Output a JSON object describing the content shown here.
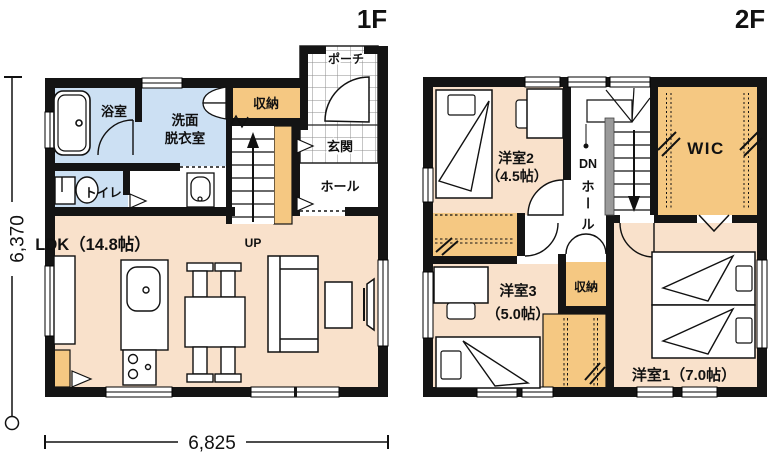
{
  "floor1": {
    "title": "1F",
    "rooms": {
      "bath": "浴室",
      "washroom1": "洗面",
      "washroom2": "脱衣室",
      "toilet": "トイレ",
      "storage": "収納",
      "porch": "ポーチ",
      "entrance": "玄関",
      "hall": "ホール",
      "ldk": "LDK（14.8帖）",
      "up": "UP"
    }
  },
  "floor2": {
    "title": "2F",
    "rooms": {
      "bedroom2": "洋室2",
      "bedroom2_size": "（4.5帖）",
      "bedroom3": "洋室3",
      "bedroom3_size": "（5.0帖）",
      "bedroom1": "洋室1（7.0帖）",
      "wic": "WIC",
      "dn": "DN",
      "hall_char1": "ホ",
      "hall_char2": "ー",
      "hall_char3": "ル",
      "storage": "収納"
    }
  },
  "dimensions": {
    "height": "6,370",
    "width": "6,825"
  },
  "palette": {
    "room_peach": "#F9E1CB",
    "wet_blue": "#CCE0F3",
    "storage_orange": "#F5C882",
    "wall_black": "#141414",
    "handrail_gray": "#9A9A9A"
  }
}
